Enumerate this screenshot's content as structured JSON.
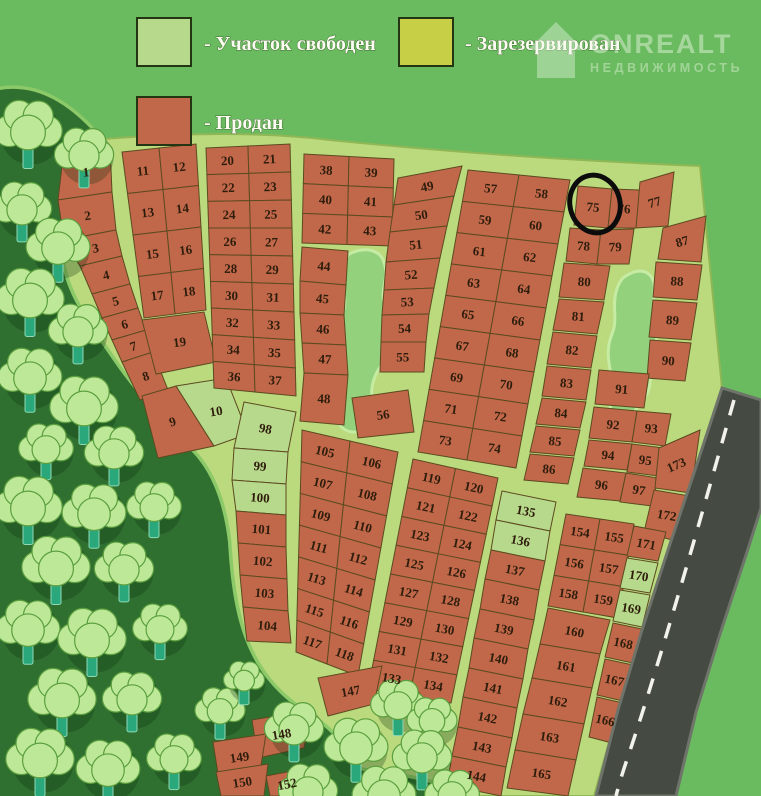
{
  "legend": {
    "items": [
      {
        "label": "- Участок свободен",
        "status": "free",
        "color": "#b7d98b"
      },
      {
        "label": "- Зарезервирован",
        "status": "reserved",
        "color": "#c6cf45"
      },
      {
        "label": "- Продан",
        "status": "sold",
        "color": "#c2684a"
      }
    ]
  },
  "logo": {
    "title": "ONREALT",
    "subtitle": "НЕДВИЖИМОСТЬ"
  },
  "map": {
    "annotated_plot": 75,
    "free_plots": [
      10,
      98,
      99,
      100,
      135,
      136,
      169,
      170
    ],
    "reserved_plots": [],
    "strips": [
      {
        "id": "A",
        "plots": [
          1,
          2,
          3,
          4,
          5,
          6,
          7,
          8
        ]
      },
      {
        "id": "A2",
        "plots": [
          9,
          10
        ]
      },
      {
        "id": "B",
        "rows": [
          [
            11,
            12
          ],
          [
            13,
            14
          ],
          [
            15,
            16
          ],
          [
            17,
            18
          ]
        ]
      },
      {
        "id": "B2",
        "plots": [
          19
        ]
      },
      {
        "id": "C",
        "rows": [
          [
            20,
            21
          ],
          [
            22,
            23
          ],
          [
            24,
            25
          ],
          [
            26,
            27
          ],
          [
            28,
            29
          ],
          [
            30,
            31
          ],
          [
            32,
            33
          ],
          [
            34,
            35
          ],
          [
            36,
            37
          ]
        ]
      },
      {
        "id": "D",
        "rows": [
          [
            38,
            39
          ],
          [
            40,
            41
          ],
          [
            42,
            43
          ]
        ]
      },
      {
        "id": "D2",
        "plots": [
          44,
          45,
          46,
          47,
          48
        ]
      },
      {
        "id": "E",
        "plots": [
          49,
          50,
          51,
          52,
          53,
          54,
          55
        ]
      },
      {
        "id": "D3",
        "plots": [
          56
        ]
      },
      {
        "id": "F",
        "rows": [
          [
            57,
            58
          ],
          [
            59,
            60
          ],
          [
            61,
            62
          ],
          [
            63,
            64
          ],
          [
            65,
            66
          ],
          [
            67,
            68
          ],
          [
            69,
            70
          ],
          [
            71,
            72
          ],
          [
            73,
            74
          ]
        ]
      },
      {
        "id": "G",
        "plots": [
          75,
          76,
          77,
          78,
          79,
          80,
          81,
          82,
          83,
          84,
          85,
          86
        ]
      },
      {
        "id": "H",
        "plots": [
          87,
          88,
          89,
          90,
          91,
          92,
          93,
          94,
          95,
          96,
          97,
          173,
          172
        ]
      },
      {
        "id": "I",
        "plots": [
          98,
          99,
          100,
          101,
          102,
          103,
          104
        ]
      },
      {
        "id": "J",
        "rows": [
          [
            105,
            106
          ],
          [
            107,
            108
          ],
          [
            109,
            110
          ],
          [
            111,
            112
          ],
          [
            113,
            114
          ],
          [
            115,
            116
          ],
          [
            117,
            118
          ]
        ]
      },
      {
        "id": "K",
        "rows": [
          [
            119,
            120
          ],
          [
            121,
            122
          ],
          [
            123,
            124
          ],
          [
            125,
            126
          ],
          [
            127,
            128
          ],
          [
            129,
            130
          ],
          [
            131,
            132
          ],
          [
            133,
            134
          ]
        ]
      },
      {
        "id": "L",
        "plots": [
          135,
          136,
          137,
          138,
          139,
          140,
          141,
          142,
          143,
          144
        ]
      },
      {
        "id": "M1",
        "rows": [
          [
            154,
            155
          ],
          [
            156,
            157
          ],
          [
            158,
            159
          ]
        ]
      },
      {
        "id": "M2",
        "plots": [
          160,
          161,
          162,
          163,
          165
        ]
      },
      {
        "id": "N",
        "plots": [
          171,
          170,
          169,
          168,
          167,
          166
        ]
      },
      {
        "id": "O",
        "plots": [
          147,
          148,
          149,
          150,
          152
        ]
      }
    ]
  }
}
